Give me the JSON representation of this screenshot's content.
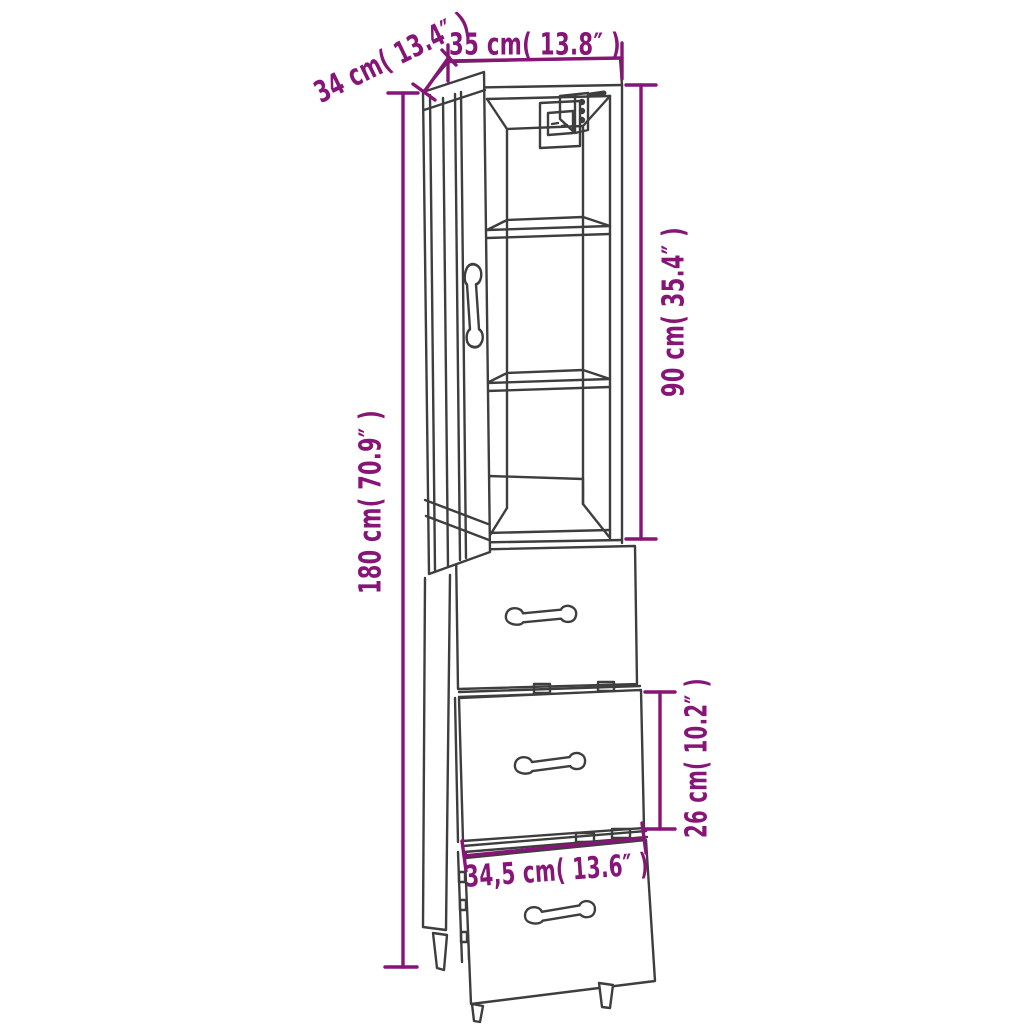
{
  "diagram": {
    "subject": "tall-cabinet-with-drawers-technical-line-drawing",
    "colors": {
      "annotation": "#871477",
      "line": "#3e3e3e",
      "background": "#ffffff"
    },
    "dimension_labels": {
      "depth": "34 cm( 13.4″ )",
      "width": "35 cm( 13.8″ )",
      "upper_section_height": "90 cm( 35.4″ )",
      "total_height": "180 cm( 70.9″ )",
      "middle_drawer_height": "26 cm( 10.2″ )",
      "bottom_drawer_width": "34,5 cm( 13.6″ )"
    }
  }
}
